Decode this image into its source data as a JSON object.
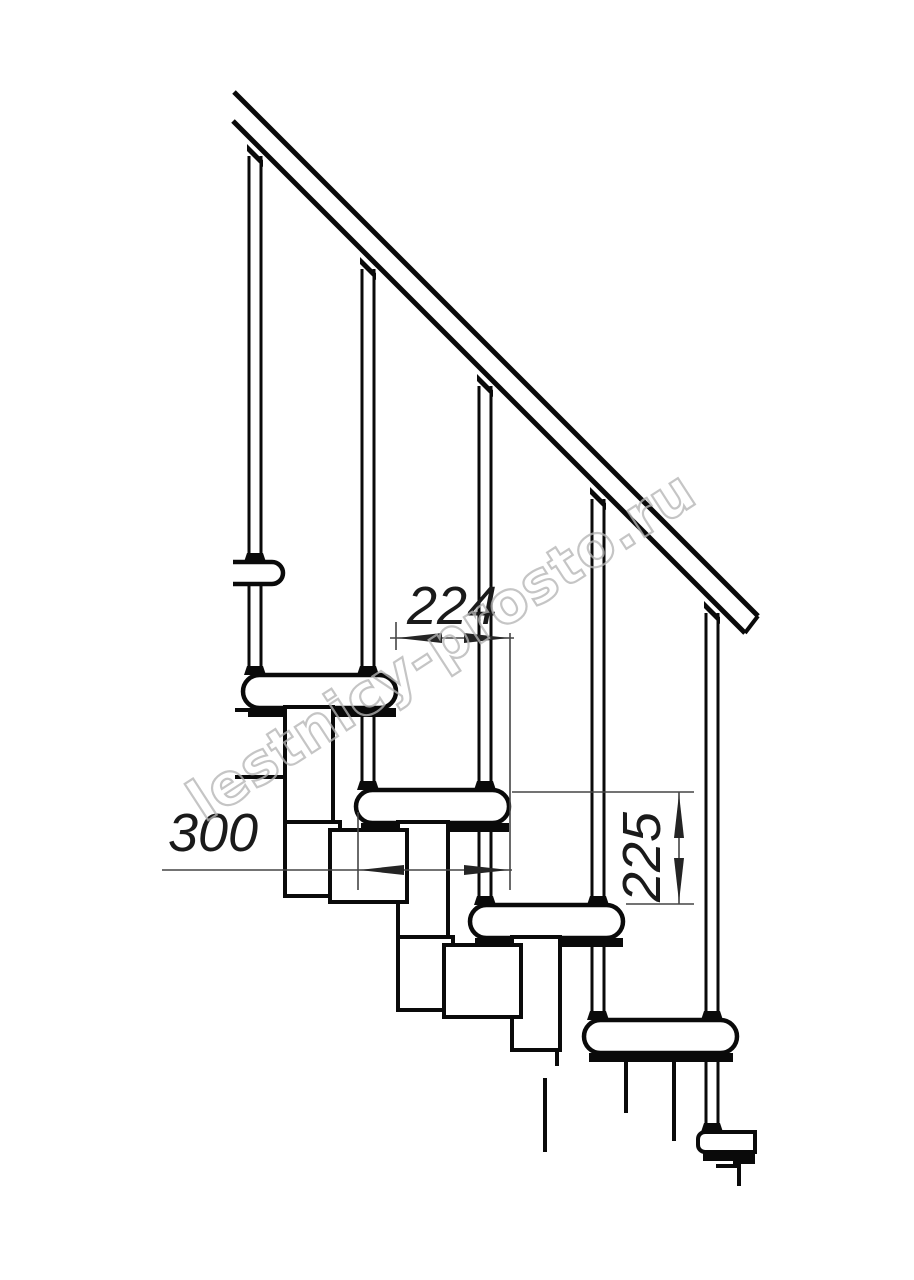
{
  "drawing": {
    "watermark": {
      "text": "lestnicy-prosto.ru"
    },
    "dimensions": {
      "step_run": {
        "value": "224"
      },
      "tread_depth": {
        "value": "300"
      },
      "step_rise": {
        "value": "225"
      }
    },
    "structure": {
      "steps_visible": 5,
      "balusters_visible": 5,
      "has_handrail": true
    },
    "colors": {
      "line": "#0a0a0a",
      "dimension_line": "#454545",
      "watermark": "#b5b5b5",
      "background": "#ffffff"
    }
  }
}
